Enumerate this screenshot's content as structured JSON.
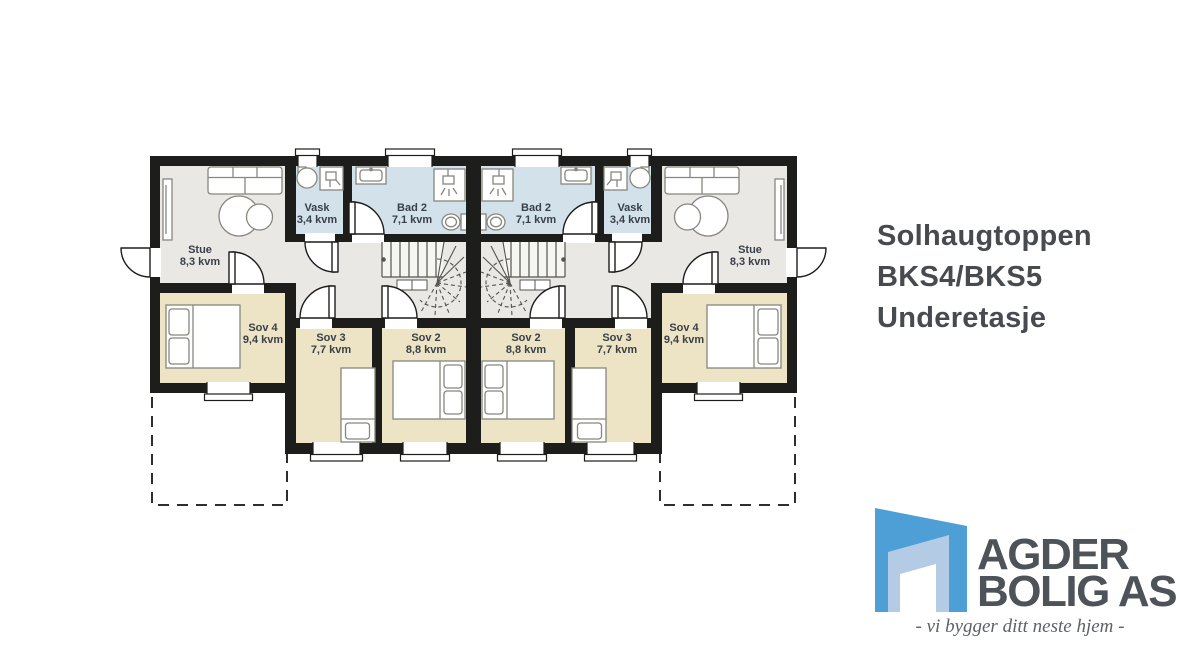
{
  "title": {
    "line1": "Solhaugtoppen",
    "line2": "BKS4/BKS5",
    "line3": "Underetasje"
  },
  "floorplan": {
    "rooms": {
      "stue": {
        "name": "Stue",
        "area": "8,3 kvm"
      },
      "vask": {
        "name": "Vask",
        "area": "3,4 kvm"
      },
      "bad2": {
        "name": "Bad 2",
        "area": "7,1 kvm"
      },
      "sov2": {
        "name": "Sov 2",
        "area": "8,8 kvm"
      },
      "sov3": {
        "name": "Sov 3",
        "area": "7,7 kvm"
      },
      "sov4": {
        "name": "Sov 4",
        "area": "9,4 kvm"
      }
    },
    "colors": {
      "wall": "#1d1d1b",
      "floor_living": "#e9e8e4",
      "floor_bedroom": "#ede3c5",
      "floor_bath": "#d2e1ea",
      "label_text": "#3a4049"
    }
  },
  "logo": {
    "name_line1": "AGDER",
    "name_line2": "BOLIG AS",
    "tagline": "- vi bygger ditt neste hjem -",
    "brand_blue": "#4d9fd6"
  }
}
